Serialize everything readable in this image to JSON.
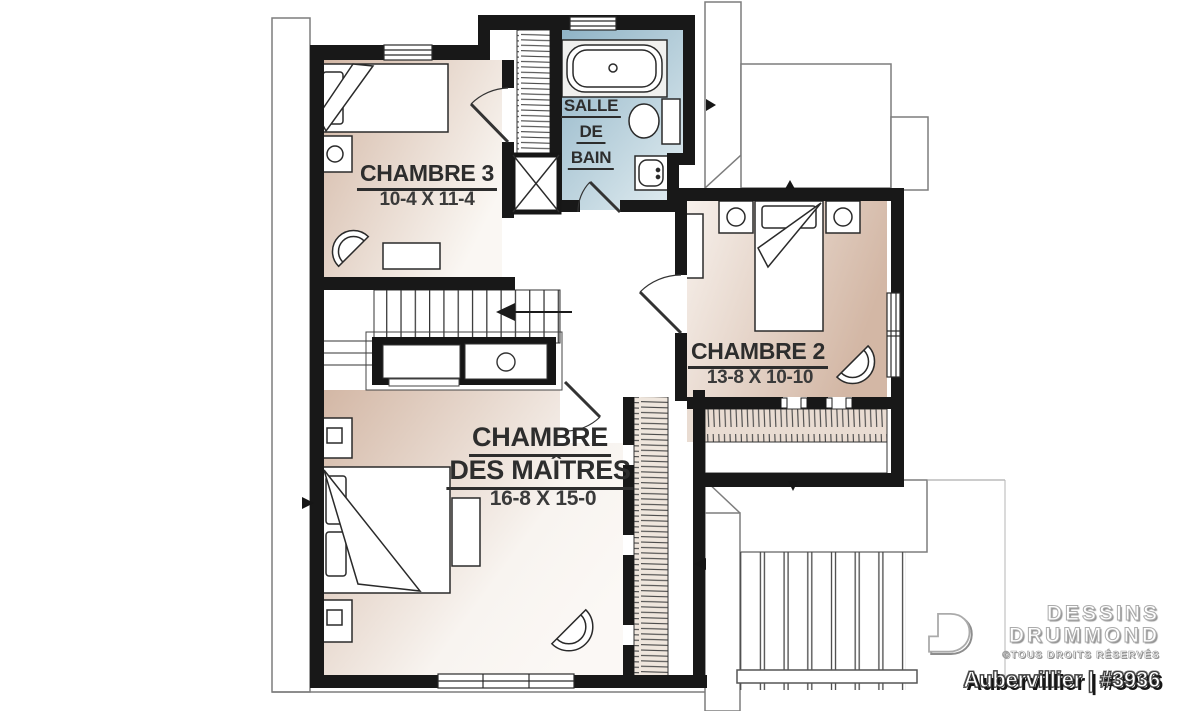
{
  "rooms": {
    "chambre3": {
      "label": "CHAMBRE 3",
      "dims": "10-4 X 11-4"
    },
    "salle_de_bain": {
      "lines": [
        "SALLE",
        "DE",
        "BAIN"
      ]
    },
    "chambre2": {
      "label": "CHAMBRE 2",
      "dims": "13-8 X 10-10"
    },
    "maitres": {
      "line1": "CHAMBRE",
      "line2": "DES MAÎTRES",
      "dims": "16-8 X 15-0"
    }
  },
  "branding": {
    "brand_line1": "DESSINS",
    "brand_line2": "DRUMMOND",
    "rights": "©TOUS DROITS RÉSERVÉS",
    "plan_title": "Aubervillier | #3936"
  },
  "colors": {
    "wall": "#181818",
    "floor_dark": "#d3b7a5",
    "floor_light": "#faf7f3",
    "bath_dark": "#8fb3c6",
    "bath_light": "#dce9ee",
    "roof_line": "#7d7d7d",
    "label_text": "#2d2d2d"
  }
}
